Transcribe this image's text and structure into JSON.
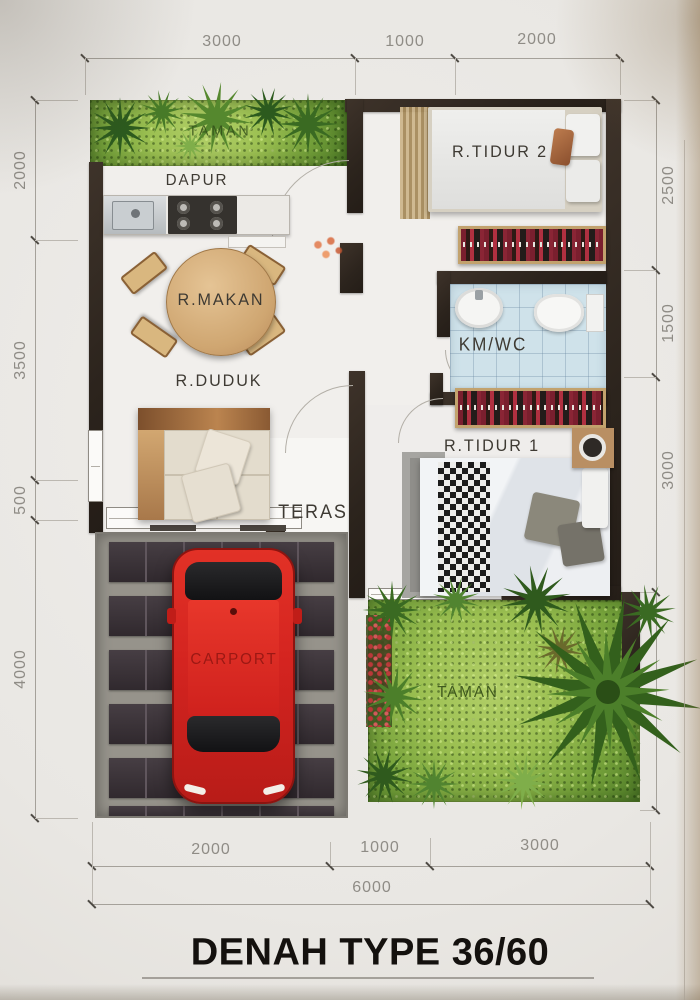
{
  "title": "DENAH TYPE 36/60",
  "rooms": {
    "taman_top": "TAMAN",
    "dapur": "DAPUR",
    "r_makan": "R.MAKAN",
    "r_tidur_2": "R.TIDUR  2",
    "km_wc": "KM/WC",
    "r_duduk": "R.DUDUK",
    "r_tidur_1": "R.TIDUR  1",
    "teras": "TERAS",
    "carport": "CARPORT",
    "taman_bottom": "TAMAN"
  },
  "dimensions": {
    "top": [
      "3000",
      "1000",
      "2000"
    ],
    "left": [
      "2000",
      "3500",
      "500",
      "4000"
    ],
    "right": [
      "2500",
      "1500",
      "3000"
    ],
    "bottom": [
      "2000",
      "1000",
      "3000"
    ],
    "total_width": "6000"
  },
  "colors": {
    "wall": "#2f2720",
    "car_red": "#d42420",
    "garden_green": "#9cc052",
    "bathroom_tile": "#cfe2ea",
    "carport_tile": "#3b3238",
    "dimension_text": "#8f8c86"
  }
}
